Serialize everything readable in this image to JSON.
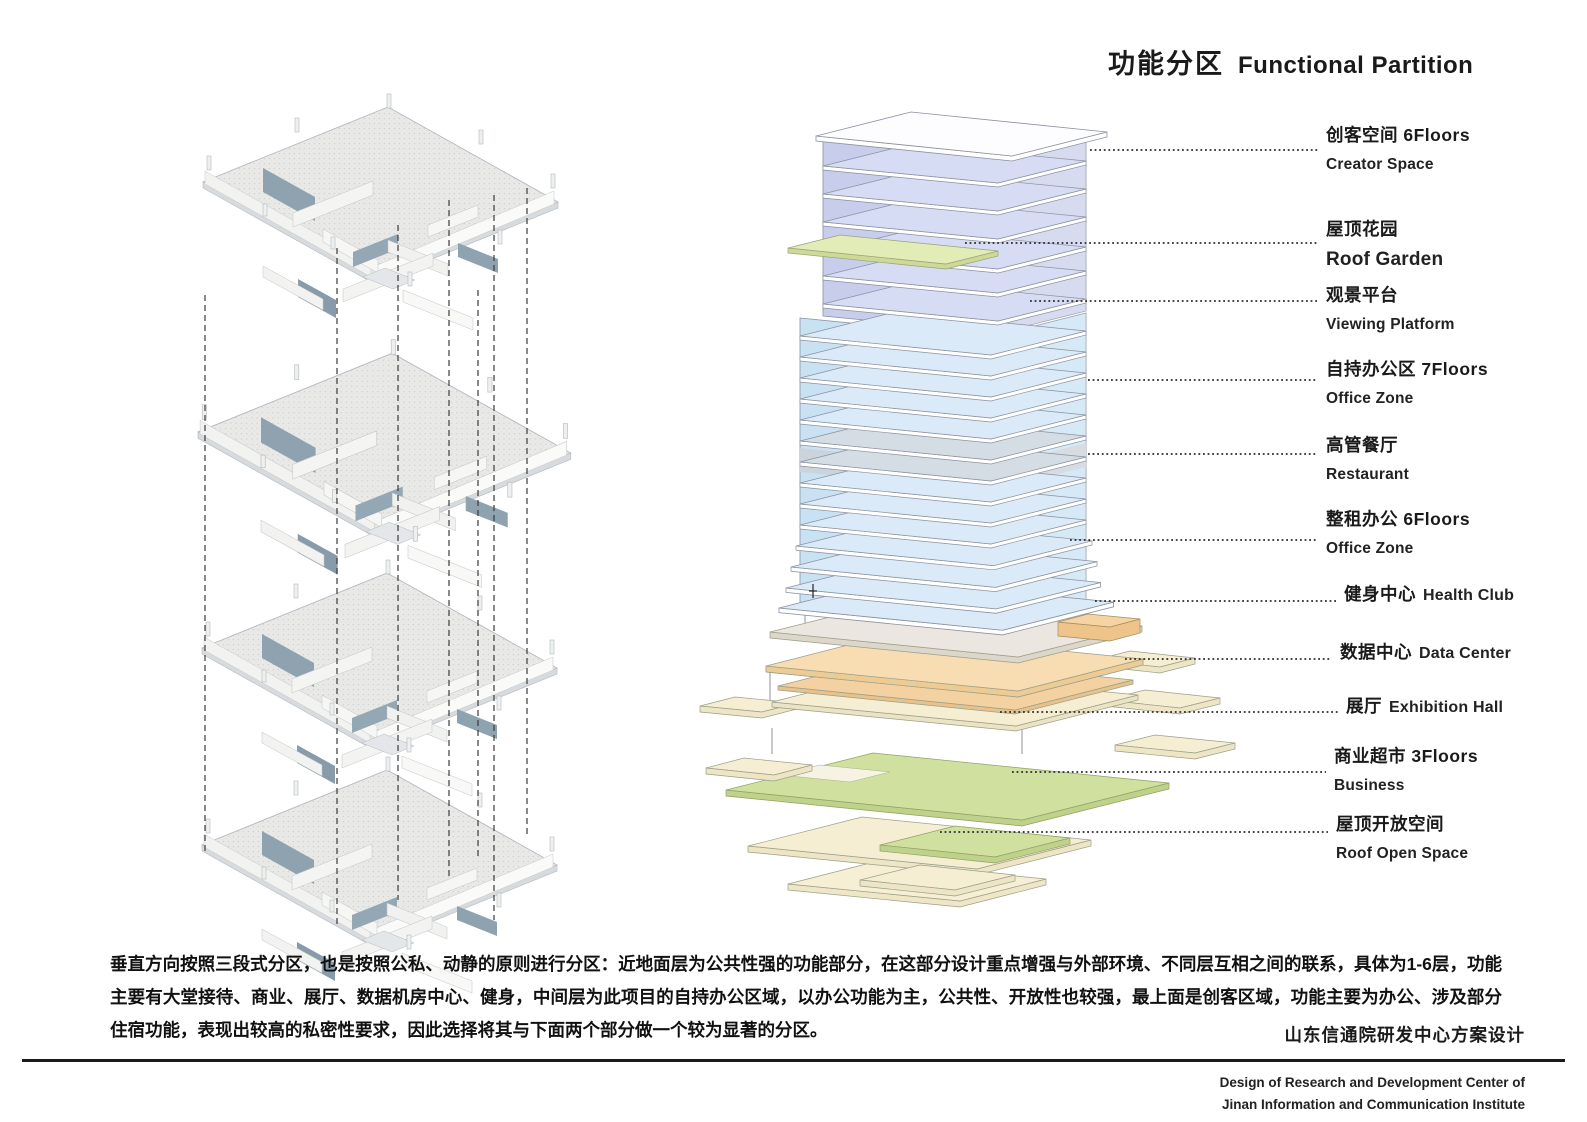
{
  "title": {
    "cn": "功能分区",
    "en": "Functional Partition"
  },
  "legend": [
    {
      "cn": "创客空间 6Floors",
      "en": "Creator Space"
    },
    {
      "cn": "屋顶花园",
      "en": "Roof Garden"
    },
    {
      "cn": "观景平台",
      "en": "Viewing Platform"
    },
    {
      "cn": "自持办公区 7Floors",
      "en": "Office Zone"
    },
    {
      "cn": "高管餐厅",
      "en": "Restaurant"
    },
    {
      "cn": "整租办公 6Floors",
      "en": "Office Zone"
    },
    {
      "cn": "健身中心",
      "en": "Health Club"
    },
    {
      "cn": "数据中心",
      "en": "Data Center"
    },
    {
      "cn": "展厅",
      "en": "Exhibition Hall"
    },
    {
      "cn": "商业超市 3Floors",
      "en": "Business"
    },
    {
      "cn": "屋顶开放空间",
      "en": "Roof Open Space"
    }
  ],
  "description": "垂直方向按照三段式分区，也是按照公私、动静的原则进行分区：近地面层为公共性强的功能部分，在这部分设计重点增强与外部环境、不同层互相之间的联系，具体为1-6层，功能主要有大堂接待、商业、展厅、数据机房中心、健身，中间层为此项目的自持办公区域，以办公功能为主，公共性、开放性也较强，最上面是创客区域，功能主要为办公、涉及部分住宿功能，表现出较高的私密性要求，因此选择将其与下面两个部分做一个较为显著的分区。",
  "project": {
    "cn": "山东信通院研发中心方案设计",
    "en_line1": "Design of Research and Development Center of",
    "en_line2": "Jinan Information and Communication Institute"
  },
  "palette": {
    "creator_space": "#c7cdeb",
    "office_tower": "#c8e2f4",
    "restaurant_band": "#ccd4db",
    "roof_garden": "#e2ecb6",
    "viewing_platform": "#c4cf9c",
    "podium_cream": "#ebe6df",
    "data_center_orange": "#f8dcb2",
    "light_cream": "#f6eed2",
    "roof_open_green": "#cfe09f",
    "plan_gray": "#e9e9e7"
  }
}
